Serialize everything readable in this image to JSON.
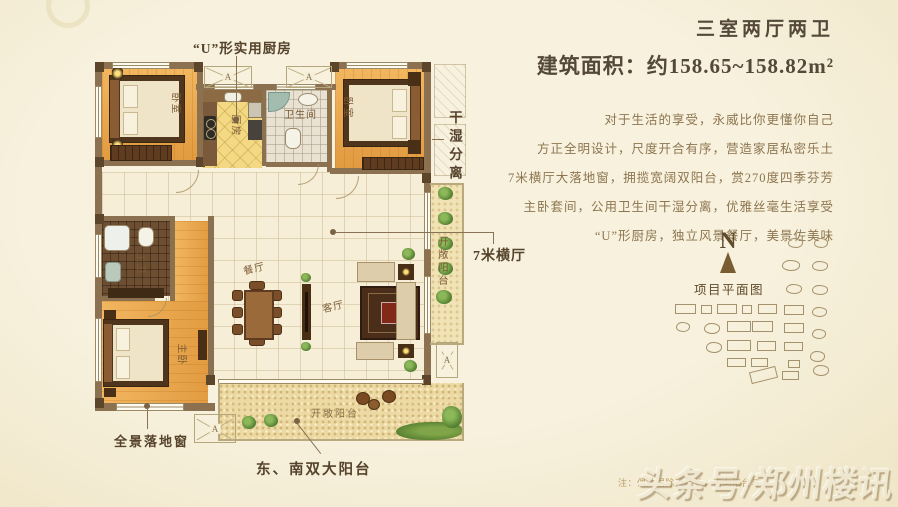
{
  "header": {
    "title": "三室两厅两卫",
    "area_line": "建筑面积：约158.65~158.82m²"
  },
  "description": {
    "lines": [
      "对于生活的享受，永威比你更懂你自己",
      "方正全明设计，尺度开合有序，营造家居私密乐土",
      "7米横厅大落地窗，拥揽宽阔双阳台，赏270度四季芬芳",
      "主卧套间，公用卫生间干湿分离，优雅丝毫生活享受",
      "“U”形厨房，独立风景餐厅，美景佐美味"
    ]
  },
  "floorplan": {
    "marker_label": "A",
    "labels": {
      "kitchen_callout": "“U”形实用厨房",
      "dry_wet": "干湿分离",
      "hall7m": "7米横厅",
      "panoramic_window": "全景落地窗",
      "double_balcony": "东、南双大阳台",
      "open_balcony": "开敞阳台",
      "bedroom": "卧室",
      "kitchen": "厨房",
      "bathroom": "卫生间",
      "master_bath": "主卫",
      "master_bedroom": "主卧",
      "dining": "餐厅",
      "living": "客厅"
    }
  },
  "siteplan": {
    "compass_label": "N",
    "title": "项目平面图",
    "buildings": [
      {
        "x": 788,
        "y": 238,
        "w": 15,
        "h": 10,
        "t": "c"
      },
      {
        "x": 814,
        "y": 238,
        "w": 14,
        "h": 10,
        "t": "c"
      },
      {
        "x": 782,
        "y": 260,
        "w": 18,
        "h": 11,
        "t": "c"
      },
      {
        "x": 812,
        "y": 261,
        "w": 16,
        "h": 10,
        "t": "c"
      },
      {
        "x": 786,
        "y": 284,
        "w": 16,
        "h": 10,
        "t": "c"
      },
      {
        "x": 812,
        "y": 285,
        "w": 16,
        "h": 10,
        "t": "c"
      },
      {
        "x": 675,
        "y": 304,
        "w": 21,
        "h": 10,
        "t": "r"
      },
      {
        "x": 701,
        "y": 305,
        "w": 11,
        "h": 9,
        "t": "r"
      },
      {
        "x": 717,
        "y": 304,
        "w": 20,
        "h": 10,
        "t": "r"
      },
      {
        "x": 742,
        "y": 305,
        "w": 10,
        "h": 9,
        "t": "r"
      },
      {
        "x": 758,
        "y": 304,
        "w": 19,
        "h": 10,
        "t": "r"
      },
      {
        "x": 784,
        "y": 305,
        "w": 20,
        "h": 10,
        "t": "r"
      },
      {
        "x": 812,
        "y": 307,
        "w": 15,
        "h": 10,
        "t": "c"
      },
      {
        "x": 676,
        "y": 322,
        "w": 14,
        "h": 10,
        "t": "c"
      },
      {
        "x": 704,
        "y": 323,
        "w": 16,
        "h": 11,
        "t": "c"
      },
      {
        "x": 727,
        "y": 321,
        "w": 24,
        "h": 11,
        "t": "r"
      },
      {
        "x": 752,
        "y": 321,
        "w": 21,
        "h": 11,
        "t": "r"
      },
      {
        "x": 784,
        "y": 323,
        "w": 20,
        "h": 10,
        "t": "r"
      },
      {
        "x": 812,
        "y": 329,
        "w": 14,
        "h": 10,
        "t": "c"
      },
      {
        "x": 706,
        "y": 342,
        "w": 16,
        "h": 11,
        "t": "c"
      },
      {
        "x": 727,
        "y": 340,
        "w": 24,
        "h": 11,
        "t": "r"
      },
      {
        "x": 757,
        "y": 341,
        "w": 19,
        "h": 10,
        "t": "r"
      },
      {
        "x": 784,
        "y": 342,
        "w": 19,
        "h": 9,
        "t": "r"
      },
      {
        "x": 810,
        "y": 351,
        "w": 15,
        "h": 11,
        "t": "c"
      },
      {
        "x": 727,
        "y": 358,
        "w": 19,
        "h": 9,
        "t": "r"
      },
      {
        "x": 751,
        "y": 358,
        "w": 17,
        "h": 9,
        "t": "r"
      },
      {
        "x": 788,
        "y": 360,
        "w": 12,
        "h": 8,
        "t": "r"
      },
      {
        "x": 813,
        "y": 365,
        "w": 16,
        "h": 11,
        "t": "c"
      },
      {
        "x": 750,
        "y": 369,
        "w": 27,
        "h": 12,
        "t": "p"
      },
      {
        "x": 782,
        "y": 371,
        "w": 17,
        "h": 9,
        "t": "r"
      }
    ]
  },
  "footer": {
    "note": "注：偶数层除顶层外，南向阳台与",
    "watermark": "头条号/郑州楼讯"
  }
}
